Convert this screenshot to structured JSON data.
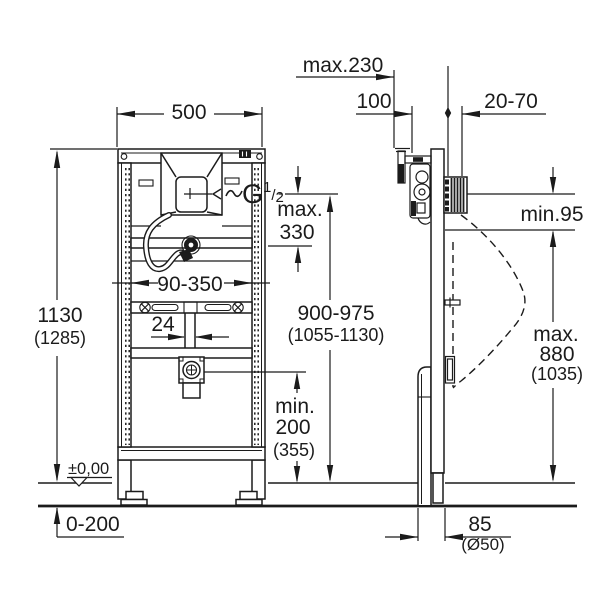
{
  "drawing": {
    "colors": {
      "ink": "#1b1b1b",
      "paper": "#ffffff"
    },
    "front_view": {
      "frame_width": "500",
      "frame_height": "1130",
      "frame_height_alt": "(1285)",
      "thread": {
        "g": "G",
        "sup": "1",
        "slash": "/",
        "sub": "2"
      },
      "supply_drop": {
        "prefix": "max.",
        "value": "330"
      },
      "rail_adjust_range": "90-350",
      "flush_pipe_width": "24",
      "inlet_height": "900-975",
      "inlet_height_alt": "(1055-1130)",
      "drain_height": {
        "prefix": "min.",
        "value": "200",
        "alt": "(355)"
      },
      "floor_level": "±0,00",
      "floor_buildup": "0-200"
    },
    "side_view": {
      "bracket_depth": "max.230",
      "bracket_offset": "100",
      "wall_clearance": "20-70",
      "rim_clearance": "min.95",
      "urinal_height": {
        "prefix": "max.",
        "value": "880",
        "alt": "(1035)"
      },
      "drain_offset": "85",
      "drain_pipe_diameter": "(Ø50)"
    }
  }
}
